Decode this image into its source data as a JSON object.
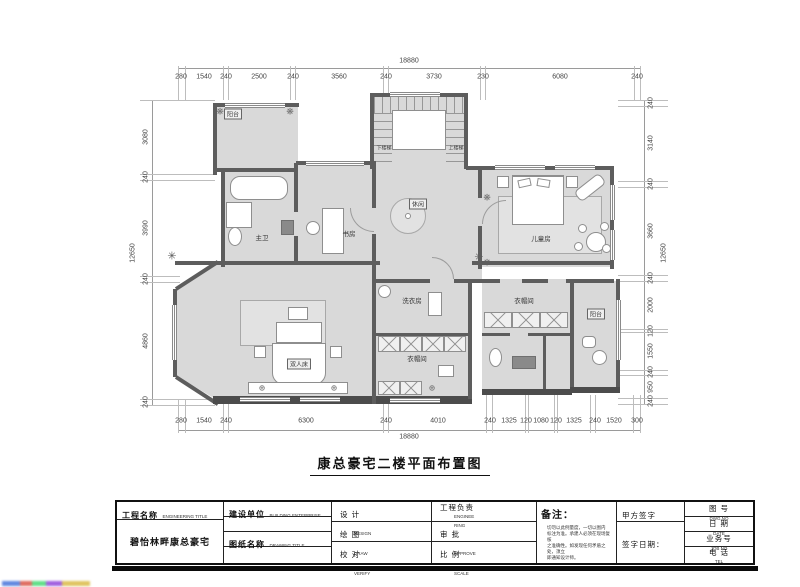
{
  "drawing_title": "康总豪宅二楼平面布置图",
  "plan": {
    "room_labels": {
      "balcony_top": "阳台",
      "master_bath": "主卫",
      "study": "书房",
      "lounge": "休闲",
      "kids_room": "儿童房",
      "master_bed": "双人床",
      "laundry": "洗衣房",
      "closet_bottom": "衣帽间",
      "closet_right": "衣帽间",
      "balcony_bottom": "阳台"
    },
    "stairs": {
      "down": "下楼梯",
      "up": "上楼梯"
    }
  },
  "dims": {
    "top": {
      "total": "18880",
      "segs": [
        "280",
        "1540",
        "240",
        "2500",
        "240",
        "3560",
        "240",
        "3730",
        "230",
        "6080",
        "240"
      ]
    },
    "bottom": {
      "total": "18880",
      "segs": [
        "280",
        "1540",
        "240",
        "6300",
        "240",
        "4010",
        "240",
        "1325",
        "120",
        "1080",
        "120",
        "1325",
        "240",
        "1520",
        "300"
      ]
    },
    "left": {
      "total": "12650",
      "segs": [
        "3080",
        "240",
        "3990",
        "240",
        "4860",
        "240"
      ]
    },
    "right": {
      "total": "12650",
      "segs": [
        "240",
        "3140",
        "240",
        "3660",
        "240",
        "2000",
        "120",
        "1550",
        "240",
        "950",
        "240"
      ]
    }
  },
  "titleblock": {
    "project_label": "工程名称",
    "project_label_en": "ENGINEERING TITLE",
    "project_name": "碧怡林畔康总豪宅",
    "client_label": "建设单位",
    "client_label_en": "BUILDING ENTERPRISE",
    "drawing_label": "图纸名称",
    "drawing_label_en": "DRAWING TITLE",
    "design": "设 计",
    "design_en": "DESIGN",
    "draft": "绘 图",
    "draft_en": "DRAW",
    "verify": "校 对",
    "verify_en": "VERIFY",
    "lead": "工程负责",
    "lead_en1": "ENGINEE",
    "lead_en2": "RING",
    "approve": "审 批",
    "approve_en": "APPROVE",
    "scale": "比 例",
    "scale_en": "SCALE",
    "notes_label": "备注：",
    "notes": [
      "切勿以此例量度，一切以图内",
      "标注为准。承建人必须在现场复核",
      "之准确性。如发现任何矛盾之处，须立",
      "即通知设计师。"
    ],
    "sign_label": "甲方签字",
    "sign_date_label": "签字日期：",
    "dwg_no": "图 号",
    "dwg_no_en": "DWG.NO",
    "date": "日 期",
    "date_en": "DATE",
    "job_no": "业务号",
    "job_no_en": "JOB NO",
    "tel": "电 话",
    "tel_en": "TEL"
  }
}
